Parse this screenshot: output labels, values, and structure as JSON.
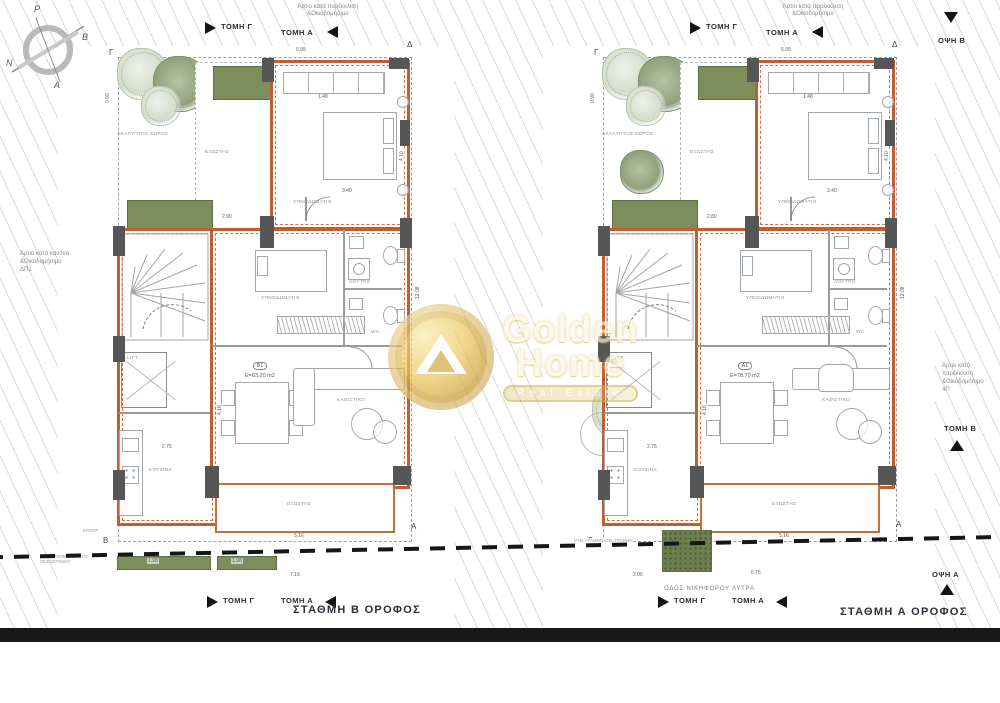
{
  "compass": {
    "top": "Ρ",
    "right": "Β",
    "left": "Ν",
    "bottom": "Α"
  },
  "watermark": {
    "name_line1": "Golden",
    "name_line2": "Home",
    "tagline": "Real Estate"
  },
  "plans": [
    {
      "top_note_line1": "Άρτιο κατά παρέκκλιση",
      "top_note_line2": "&Οικοδομήσιμο",
      "section_flag_g": "ΤΟΜΗ Γ",
      "section_flag_a": "ΤΟΜΗ Α",
      "corner_tl": "Γ",
      "corner_tr": "Δ",
      "corner_a": "Α",
      "corner_b": "Β",
      "side_note_line1": "Άρτιο κατά κανόνα",
      "side_note_line2": "&Οικοδομήσιμο",
      "side_note_line3": "ΔΠ1",
      "rooms": {
        "uncovered": "ΑΚΑΛΥΠΤΟΣ ΧΩΡΟΣ",
        "terrace": "ΕΞΩΣΤΗΣ",
        "bedroom1": "ΥΠΝΟΔΩΜΑΤΙΟ",
        "bedroom2": "ΥΠΝΟΔΩΜΑΤΙΟ",
        "bath": "ΛΟΥΤΡΟ",
        "wc": "WC",
        "living": "ΚΑΘΙΣΤΙΚΟ",
        "kitchen": "ΚΟΥΖΙΝΑ",
        "lift": "LIFT",
        "balcony": "ΕΞΩΣΤΗΣ",
        "erker": "ΕΡΚΕΡ"
      },
      "unit": {
        "id": "Β1",
        "area": "Ε=63.20 m2"
      },
      "dims": [
        "5.95",
        "0.90",
        "2.90",
        "1.48",
        "3.40",
        "4.10",
        "2.75",
        "4.18",
        "5.16",
        "7.16",
        "12.08",
        "1.98",
        "1.98"
      ],
      "bottom_flag_g": "ΤΟΜΗ Γ",
      "bottom_flag_a": "ΤΟΜΗ Α",
      "title": "ΣΤΑΘΜΗ Β ΟΡΟΦΟΣ",
      "sidewalk_note_line1": "ΔΙΑΜΟΡΦΩΜΕΝΟ ΑΚΡΟ",
      "sidewalk_note_line2": "ΠΕΖΟΔΡΟΜΙΟΥ"
    },
    {
      "top_note_line1": "Άρτιο κατά παρέκκλιση",
      "top_note_line2": "&Οικοδομήσιμο",
      "section_flag_g": "ΤΟΜΗ Γ",
      "section_flag_a": "ΤΟΜΗ Α",
      "corner_tl": "Γ",
      "corner_tr": "Δ",
      "corner_a": "Α",
      "corner_b": "Β",
      "side_note_line1": "Άρτιο κατά παρέκκλιση",
      "side_note_line2": "&Οικοδομήσιμο",
      "side_note_line3": "4Π",
      "rooms": {
        "uncovered": "ΑΚΑΛΥΠΤΟΣ ΧΩΡΟΣ",
        "terrace": "ΕΞΩΣΤΗΣ",
        "bedroom1": "ΥΠΝΟΔΩΜΑΤΙΟ",
        "bedroom2": "ΥΠΝΟΔΩΜΑΤΙΟ",
        "bath": "ΛΟΥΤΡΟ",
        "wc": "WC",
        "living": "ΚΑΘΙΣΤΙΚΟ",
        "kitchen": "ΚΟΥΖΙΝΑ",
        "lift": "LIFT",
        "balcony": "ΕΞΩΣΤΗΣ"
      },
      "unit": {
        "id": "Α1",
        "area": "Ε=78.70 m2"
      },
      "dims": [
        "5.95",
        "0.90",
        "2.80",
        "1.48",
        "3.40",
        "4.10",
        "2.75",
        "4.18",
        "5.16",
        "5.75",
        "12.08",
        "2.06"
      ],
      "bottom_flag_g": "ΤΟΜΗ Γ",
      "bottom_flag_a": "ΤΟΜΗ Α",
      "title": "ΣΤΑΘΜΗ Α ΟΡΟΦΟΣ",
      "street_name": "ΟΔΟΣ ΝΙΚΗΦΟΡΟΥ ΛΥΤΡΑ",
      "line_note": "ΡΥΜ. ΓΡΑΜΜΗ=ΟΙΚ. ΓΡΑΜΜΗ",
      "view_a": "ΟΨΗ Α",
      "view_b": "ΟΨΗ Β",
      "section_b": "ΤΟΜΗ Β"
    }
  ]
}
